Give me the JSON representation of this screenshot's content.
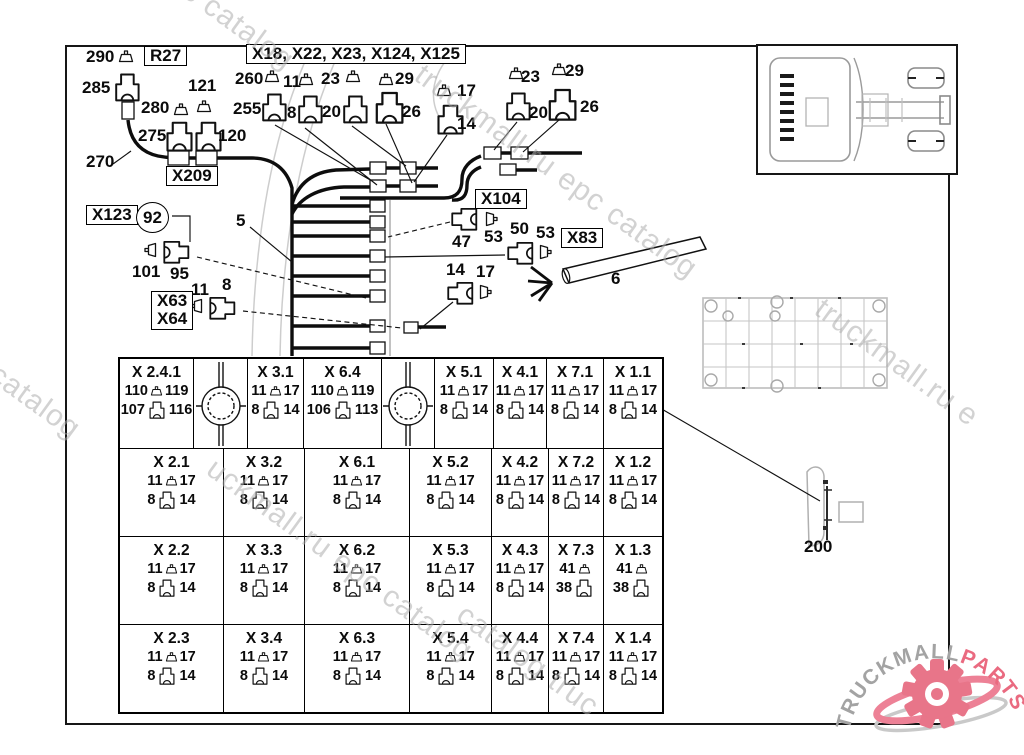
{
  "watermark": {
    "text": "truckmall.ru epc catalog",
    "fragments": [
      {
        "t": "c catalog",
        "x": 196,
        "y": -26,
        "a": 36,
        "fs": 30
      },
      {
        "t": "truckmall.ru epc catalog",
        "x": 428,
        "y": 58,
        "a": 36,
        "fs": 30
      },
      {
        "t": "l epc catalog",
        "x": -60,
        "y": 312,
        "a": 36,
        "fs": 30
      },
      {
        "t": "truckmall.ru e",
        "x": 828,
        "y": 292,
        "a": 36,
        "fs": 30
      },
      {
        "t": "uckmall.ru epc catalog",
        "x": 220,
        "y": 452,
        "a": 36,
        "fs": 30
      },
      {
        "t": "catalog truc",
        "x": 470,
        "y": 598,
        "a": 36,
        "fs": 30
      }
    ]
  },
  "logo": {
    "gray": "TRUCKMALL",
    "pink": "PARTS",
    "pink_color": "#ea6a80",
    "gray_color": "#a3a3a3"
  },
  "diagram": {
    "labels": [
      {
        "t": "290",
        "x": 86,
        "y": 48
      },
      {
        "t": "R27",
        "x": 144,
        "y": 46,
        "b": 1
      },
      {
        "t": "285",
        "x": 82,
        "y": 79
      },
      {
        "t": "121",
        "x": 188,
        "y": 77
      },
      {
        "t": "280",
        "x": 141,
        "y": 99
      },
      {
        "t": "275",
        "x": 138,
        "y": 127
      },
      {
        "t": "120",
        "x": 218,
        "y": 127
      },
      {
        "t": "270",
        "x": 86,
        "y": 153
      },
      {
        "t": "X209",
        "x": 166,
        "y": 166,
        "b": 1
      },
      {
        "t": "X18, X22, X23, X124, X125",
        "x": 246,
        "y": 44,
        "b": 1
      },
      {
        "t": "260",
        "x": 235,
        "y": 70
      },
      {
        "t": "11",
        "x": 283,
        "y": 73
      },
      {
        "t": "23",
        "x": 321,
        "y": 70
      },
      {
        "t": "29",
        "x": 395,
        "y": 70
      },
      {
        "t": "255",
        "x": 233,
        "y": 100
      },
      {
        "t": "8",
        "x": 287,
        "y": 104
      },
      {
        "t": "20",
        "x": 322,
        "y": 103
      },
      {
        "t": "26",
        "x": 402,
        "y": 103
      },
      {
        "t": "17",
        "x": 457,
        "y": 82
      },
      {
        "t": "14",
        "x": 457,
        "y": 115
      },
      {
        "t": "23",
        "x": 521,
        "y": 68
      },
      {
        "t": "29",
        "x": 565,
        "y": 62
      },
      {
        "t": "20",
        "x": 529,
        "y": 104
      },
      {
        "t": "26",
        "x": 580,
        "y": 98
      },
      {
        "t": "X104",
        "x": 475,
        "y": 189,
        "b": 1
      },
      {
        "t": "47",
        "x": 452,
        "y": 233
      },
      {
        "t": "53",
        "x": 484,
        "y": 228
      },
      {
        "t": "50",
        "x": 510,
        "y": 220
      },
      {
        "t": "53",
        "x": 536,
        "y": 224
      },
      {
        "t": "X83",
        "x": 561,
        "y": 228,
        "b": 1
      },
      {
        "t": "6",
        "x": 611,
        "y": 270
      },
      {
        "t": "14",
        "x": 446,
        "y": 261
      },
      {
        "t": "17",
        "x": 476,
        "y": 263
      },
      {
        "t": "X123",
        "x": 86,
        "y": 205,
        "b": 1
      },
      {
        "t": "92",
        "x": 136,
        "y": 202,
        "c": 1
      },
      {
        "t": "101",
        "x": 132,
        "y": 263
      },
      {
        "t": "95",
        "x": 170,
        "y": 265
      },
      {
        "t": "X63|X64",
        "x": 151,
        "y": 291,
        "b": 1
      },
      {
        "t": "11",
        "x": 191,
        "y": 281
      },
      {
        "t": "8",
        "x": 222,
        "y": 276
      },
      {
        "t": "5",
        "x": 236,
        "y": 212
      },
      {
        "t": "200",
        "x": 804,
        "y": 538
      }
    ],
    "glyphs": [
      {
        "k": "pin",
        "x": 118,
        "y": 50,
        "s": 1,
        "r": 0
      },
      {
        "k": "pin",
        "x": 196,
        "y": 100,
        "s": 1,
        "r": 0
      },
      {
        "k": "pin",
        "x": 173,
        "y": 103,
        "s": 1,
        "r": 0
      },
      {
        "k": "pin",
        "x": 264,
        "y": 70,
        "s": 1,
        "r": 0
      },
      {
        "k": "pin",
        "x": 298,
        "y": 73,
        "s": 1,
        "r": 0
      },
      {
        "k": "pin",
        "x": 345,
        "y": 70,
        "s": 1,
        "r": 0
      },
      {
        "k": "pin",
        "x": 378,
        "y": 73,
        "s": 1,
        "r": 0
      },
      {
        "k": "pin",
        "x": 436,
        "y": 84,
        "s": 1,
        "r": 0
      },
      {
        "k": "pin",
        "x": 508,
        "y": 67,
        "s": 1,
        "r": 0
      },
      {
        "k": "pin",
        "x": 551,
        "y": 63,
        "s": 1,
        "r": 0
      },
      {
        "k": "housing",
        "x": 112,
        "y": 71,
        "s": 1.4,
        "r": 0
      },
      {
        "k": "housing",
        "x": 163,
        "y": 119,
        "s": 1.5,
        "r": 0
      },
      {
        "k": "housing",
        "x": 192,
        "y": 119,
        "s": 1.5,
        "r": 0
      },
      {
        "k": "housing",
        "x": 259,
        "y": 91,
        "s": 1.4,
        "r": 0
      },
      {
        "k": "housing",
        "x": 295,
        "y": 93,
        "s": 1.4,
        "r": 0
      },
      {
        "k": "housing",
        "x": 340,
        "y": 93,
        "s": 1.4,
        "r": 0
      },
      {
        "k": "housing",
        "x": 372,
        "y": 89,
        "s": 1.6,
        "r": 0
      },
      {
        "k": "housing",
        "x": 434,
        "y": 102,
        "s": 1.5,
        "r": 0
      },
      {
        "k": "housing",
        "x": 503,
        "y": 90,
        "s": 1.4,
        "r": 0
      },
      {
        "k": "housing",
        "x": 545,
        "y": 86,
        "s": 1.6,
        "r": 0
      },
      {
        "k": "pin",
        "x": 143,
        "y": 243,
        "s": 1,
        "r": -90
      },
      {
        "k": "housing",
        "x": 163,
        "y": 238,
        "s": 1.3,
        "r": 90
      },
      {
        "k": "pin",
        "x": 189,
        "y": 299,
        "s": 1,
        "r": -90
      },
      {
        "k": "housing",
        "x": 209,
        "y": 294,
        "s": 1.3,
        "r": 90
      },
      {
        "k": "housing",
        "x": 449,
        "y": 205,
        "s": 1.3,
        "r": -90
      },
      {
        "k": "pin",
        "x": 483,
        "y": 212,
        "s": 1,
        "r": 90
      },
      {
        "k": "housing",
        "x": 505,
        "y": 239,
        "s": 1.3,
        "r": -90
      },
      {
        "k": "pin",
        "x": 537,
        "y": 245,
        "s": 1,
        "r": 90
      },
      {
        "k": "housing",
        "x": 445,
        "y": 279,
        "s": 1.3,
        "r": -90
      },
      {
        "k": "pin",
        "x": 477,
        "y": 285,
        "s": 1,
        "r": 90
      }
    ]
  },
  "table": {
    "rows": [
      {
        "h": 90,
        "cells": [
          {
            "n": "X 2.4.1",
            "p": [
              "110",
              "119"
            ],
            "h": [
              "107",
              "116"
            ],
            "w": 74
          },
          {
            "g": 1,
            "w": 54
          },
          {
            "n": "X 3.1",
            "p": [
              "11",
              "17"
            ],
            "h": [
              "8",
              "14"
            ],
            "w": 56
          },
          {
            "n": "X 6.4",
            "p": [
              "110",
              "119"
            ],
            "h": [
              "106",
              "113"
            ],
            "w": 78
          },
          {
            "g": 1,
            "w": 53
          },
          {
            "n": "X 5.1",
            "p": [
              "11",
              "17"
            ],
            "h": [
              "8",
              "14"
            ],
            "w": 59
          },
          {
            "n": "X 4.1",
            "p": [
              "11",
              "17"
            ],
            "h": [
              "8",
              "14"
            ],
            "w": 53
          },
          {
            "n": "X 7.1",
            "p": [
              "11",
              "17"
            ],
            "h": [
              "8",
              "14"
            ],
            "w": 57
          },
          {
            "n": "X 1.1",
            "p": [
              "11",
              "17"
            ],
            "h": [
              "8",
              "14"
            ],
            "w": 58
          }
        ]
      },
      {
        "h": 88,
        "cells": [
          {
            "n": "X 2.1",
            "p": [
              "11",
              "17"
            ],
            "h": [
              "8",
              "14"
            ],
            "w": 104
          },
          {
            "n": "X 3.2",
            "p": [
              "11",
              "17"
            ],
            "h": [
              "8",
              "14"
            ],
            "w": 81
          },
          {
            "n": "X 6.1",
            "p": [
              "11",
              "17"
            ],
            "h": [
              "8",
              "14"
            ],
            "w": 105
          },
          {
            "n": "X 5.2",
            "p": [
              "11",
              "17"
            ],
            "h": [
              "8",
              "14"
            ],
            "w": 82
          },
          {
            "n": "X 4.2",
            "p": [
              "11",
              "17"
            ],
            "h": [
              "8",
              "14"
            ],
            "w": 57
          },
          {
            "n": "X 7.2",
            "p": [
              "11",
              "17"
            ],
            "h": [
              "8",
              "14"
            ],
            "w": 55
          },
          {
            "n": "X 1.2",
            "p": [
              "11",
              "17"
            ],
            "h": [
              "8",
              "14"
            ],
            "w": 58
          }
        ]
      },
      {
        "h": 88,
        "cells": [
          {
            "n": "X 2.2",
            "p": [
              "11",
              "17"
            ],
            "h": [
              "8",
              "14"
            ],
            "w": 104
          },
          {
            "n": "X 3.3",
            "p": [
              "11",
              "17"
            ],
            "h": [
              "8",
              "14"
            ],
            "w": 81
          },
          {
            "n": "X 6.2",
            "p": [
              "11",
              "17"
            ],
            "h": [
              "8",
              "14"
            ],
            "w": 105
          },
          {
            "n": "X 5.3",
            "p": [
              "11",
              "17"
            ],
            "h": [
              "8",
              "14"
            ],
            "w": 82
          },
          {
            "n": "X 4.3",
            "p": [
              "11",
              "17"
            ],
            "h": [
              "8",
              "14"
            ],
            "w": 57
          },
          {
            "n": "X 7.3",
            "p": [
              "41",
              ""
            ],
            "h": [
              "38",
              ""
            ],
            "w": 55
          },
          {
            "n": "X 1.3",
            "p": [
              "41",
              ""
            ],
            "h": [
              "38",
              ""
            ],
            "w": 58
          }
        ]
      },
      {
        "h": 87,
        "cells": [
          {
            "n": "X 2.3",
            "p": [
              "11",
              "17"
            ],
            "h": [
              "8",
              "14"
            ],
            "w": 104
          },
          {
            "n": "X 3.4",
            "p": [
              "11",
              "17"
            ],
            "h": [
              "8",
              "14"
            ],
            "w": 81
          },
          {
            "n": "X 6.3",
            "p": [
              "11",
              "17"
            ],
            "h": [
              "8",
              "14"
            ],
            "w": 105
          },
          {
            "n": "X 5.4",
            "p": [
              "11",
              "17"
            ],
            "h": [
              "8",
              "14"
            ],
            "w": 82
          },
          {
            "n": "X 4.4",
            "p": [
              "11",
              "17"
            ],
            "h": [
              "8",
              "14"
            ],
            "w": 57
          },
          {
            "n": "X 7.4",
            "p": [
              "11",
              "17"
            ],
            "h": [
              "8",
              "14"
            ],
            "w": 55
          },
          {
            "n": "X 1.4",
            "p": [
              "11",
              "17"
            ],
            "h": [
              "8",
              "14"
            ],
            "w": 58
          }
        ]
      }
    ]
  }
}
